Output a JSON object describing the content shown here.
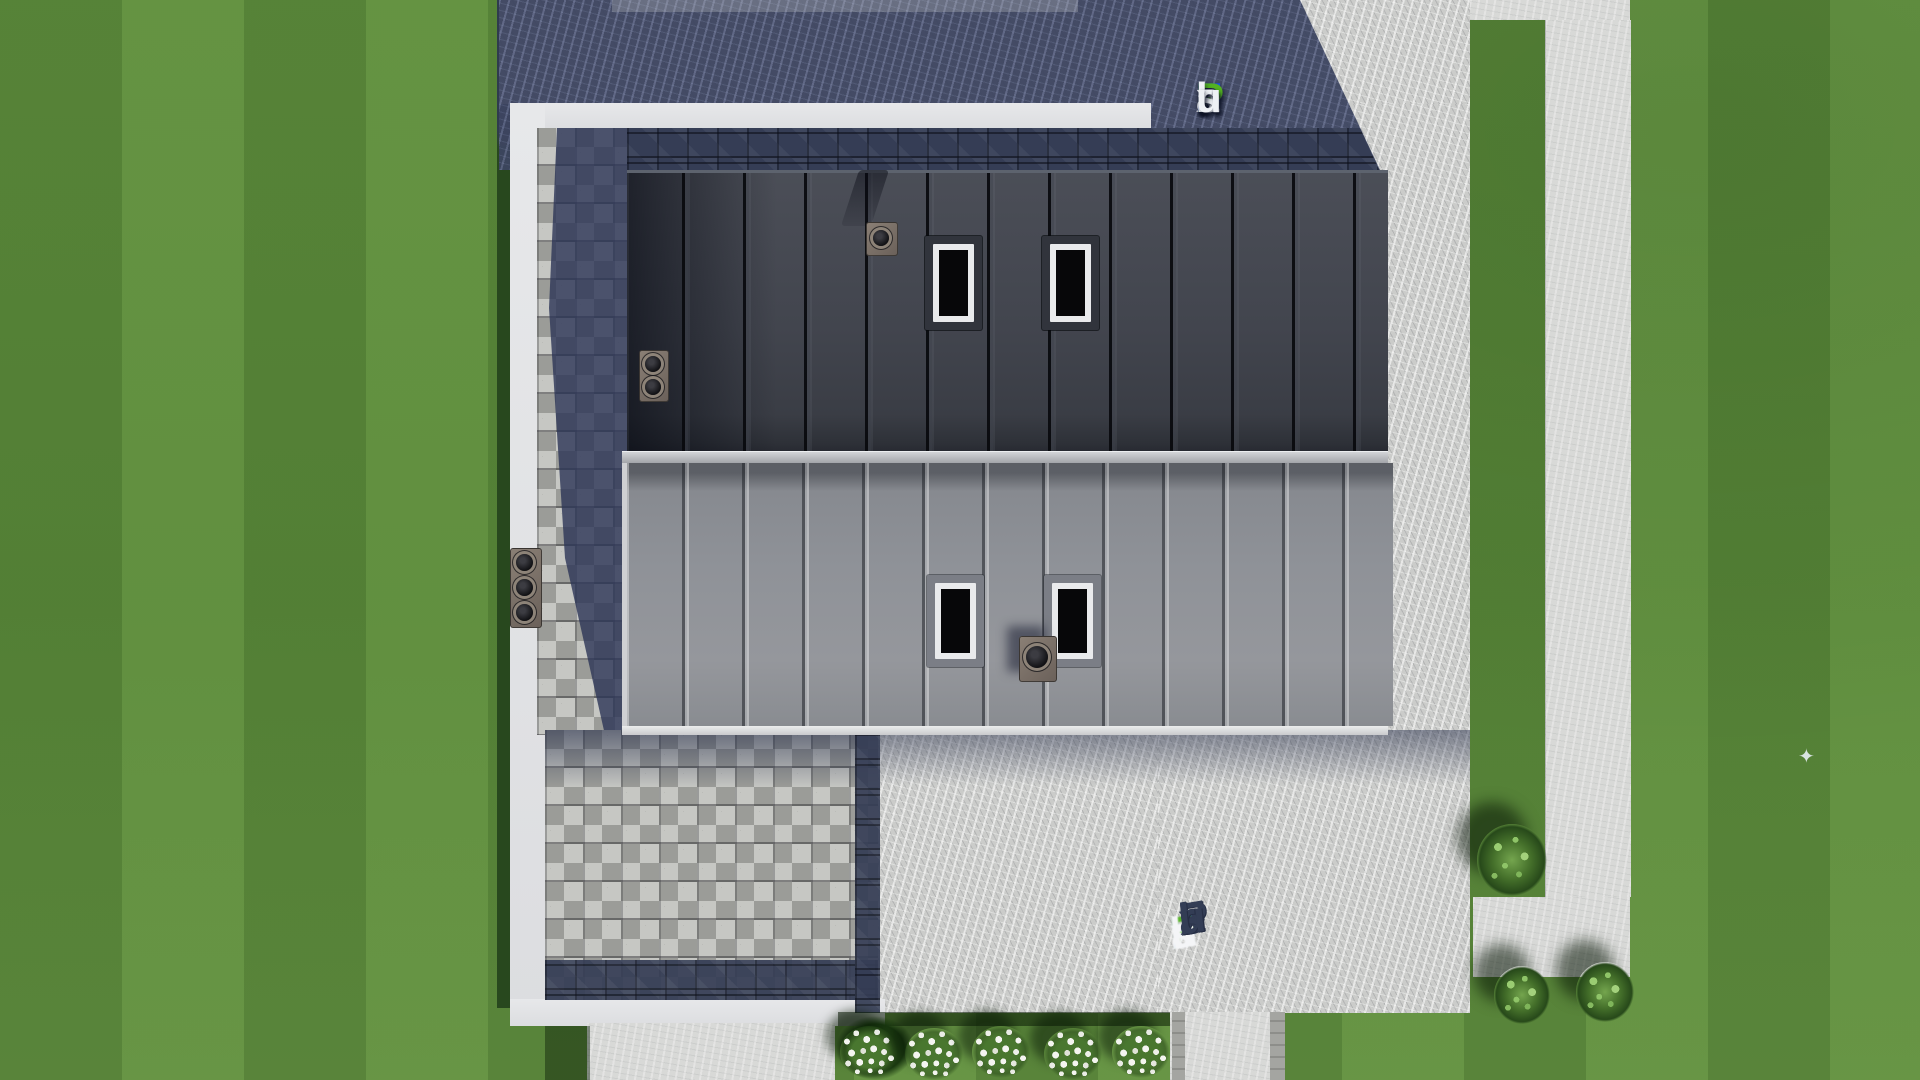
{
  "scene": {
    "description": "Aerial top-down 3D render of a single-family house: two-tone standing-seam metal roof with four skylights and roof vents, shadowed stamped-concrete terrace, paver driveway and walkways, lawn with garden paths, round bushes and white flower beds",
    "watermark_top": {
      "text": "FixPlans.ru",
      "parts": [
        {
          "ch": "F",
          "color": "#1d55ee"
        },
        {
          "ch": "i",
          "color": "#eef1f5"
        },
        {
          "ch": "x",
          "color": "#eef1f5"
        },
        {
          "ch": "P",
          "color": "#52b222"
        },
        {
          "ch": "l",
          "color": "#eef1f5"
        },
        {
          "ch": "a",
          "color": "#eef1f5"
        },
        {
          "ch": "n",
          "color": "#eef1f5"
        },
        {
          "ch": "s",
          "color": "#eef1f5"
        },
        {
          "ch": ".",
          "color": "#1d55ee"
        },
        {
          "ch": "r",
          "color": "#eef1f5"
        },
        {
          "ch": "u",
          "color": "#eef1f5"
        }
      ]
    },
    "watermark_ground": {
      "text": "FixPlans.ru",
      "top_color": "#333d55",
      "parts": [
        {
          "ch": "F",
          "color": "#2e86e0"
        },
        {
          "ch": "i",
          "color": "#58c02e"
        },
        {
          "ch": "x",
          "color": "#f4f5f7"
        },
        {
          "ch": "P",
          "color": "#5ab42c"
        },
        {
          "ch": "l",
          "color": "#f4f5f7"
        },
        {
          "ch": "a",
          "color": "#f4f5f7"
        },
        {
          "ch": "n",
          "color": "#f4f5f7"
        },
        {
          "ch": "s",
          "color": "#f4f5f7"
        },
        {
          "ch": ".",
          "color": "#2e86e0"
        },
        {
          "ch": "r",
          "color": "#f4f5f7"
        },
        {
          "ch": "u",
          "color": "#f4f5f7"
        }
      ]
    },
    "sparkle_glyph": "✦",
    "palette": {
      "lawn": "#5d8c3c",
      "lawn_shadow": "#24431c",
      "roof_dark": "#41444d",
      "roof_light": "#8e9196",
      "ridge_cap": "#b2b4b8",
      "terrace_light": "#cbccca",
      "terrace_shadow": "#3d4560",
      "paver_light": "#b4b5b1",
      "paver_shadow": "#353d55",
      "walkway_white": "#e1e2e4",
      "skylight_glass": "#070709",
      "bush_green": "#446f2a",
      "flower_white": "#f4f5f0"
    },
    "features": {
      "skylights_upper_roof": 2,
      "skylights_lower_roof": 2,
      "roof_vents": 4,
      "bushes": 3,
      "flower_clusters": 5
    }
  }
}
